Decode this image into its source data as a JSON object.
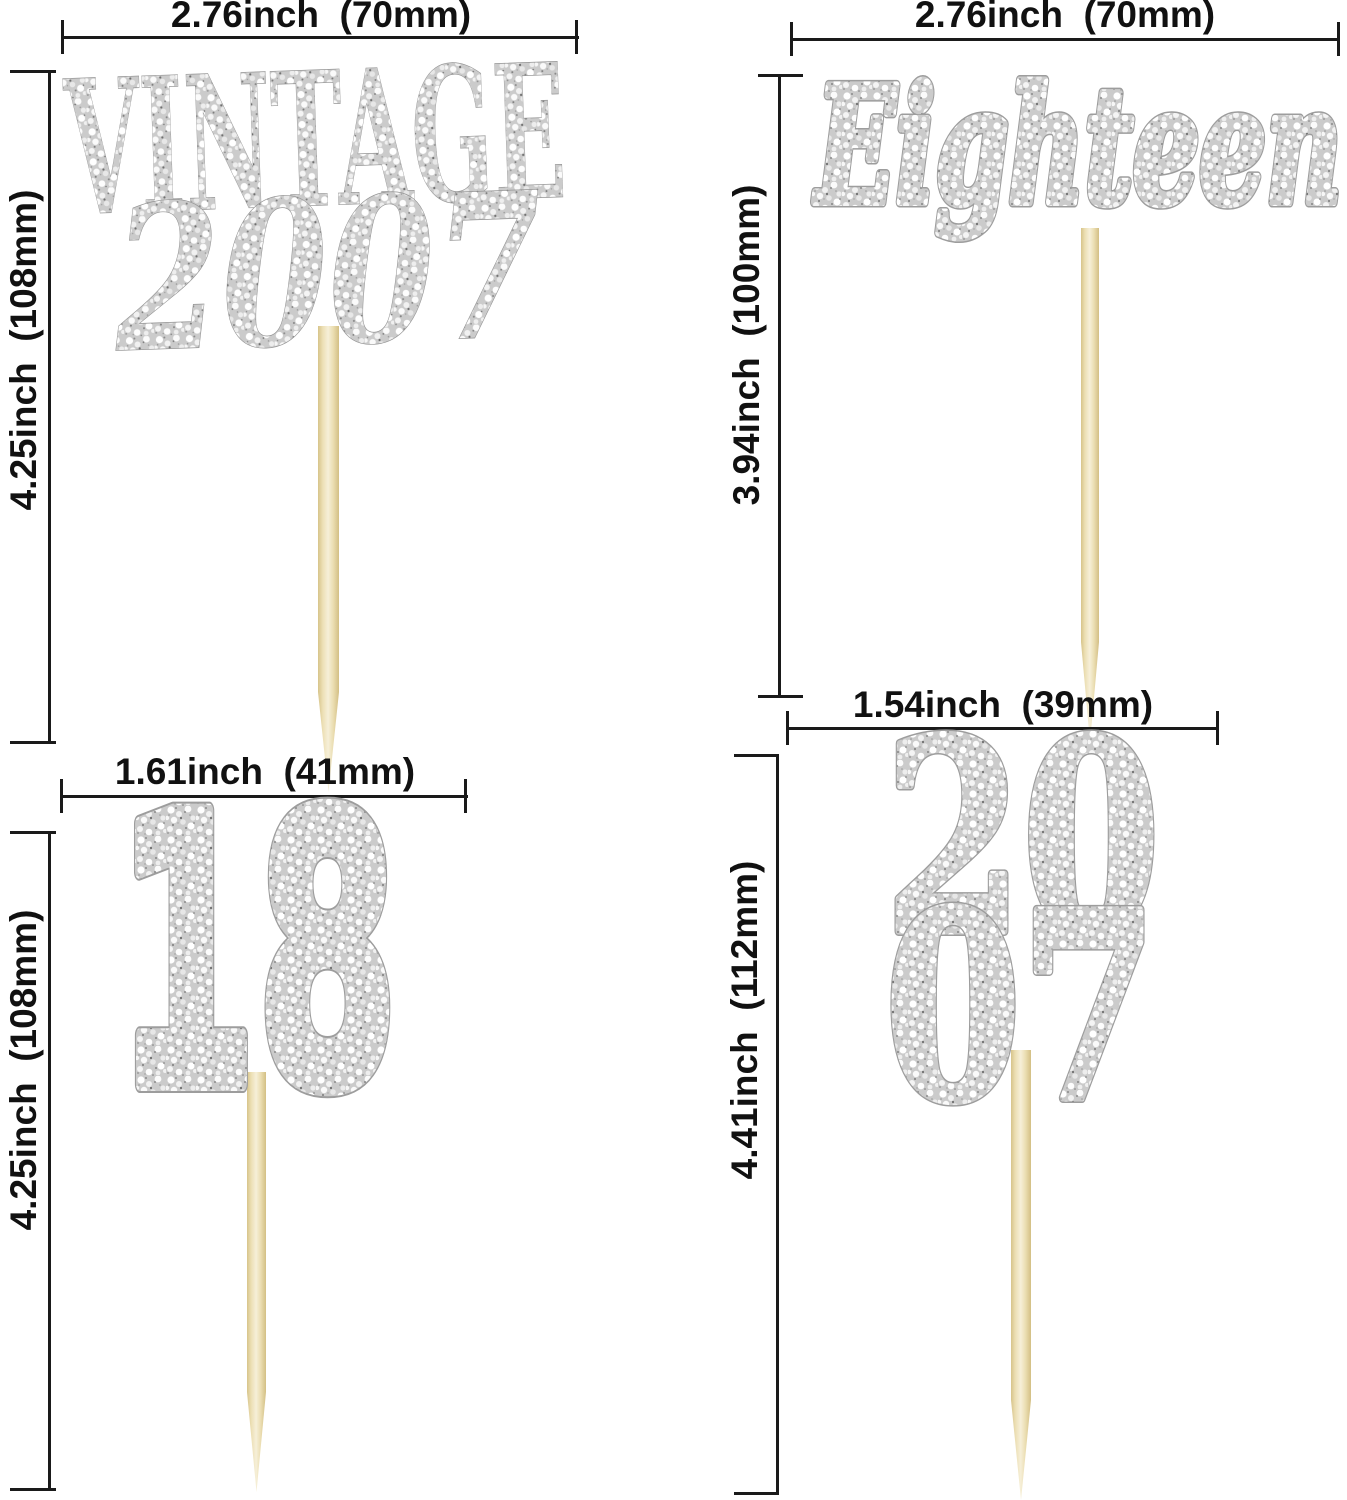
{
  "sheet": {
    "background": "#ffffff",
    "dimension_line_color": "#1a1a1a",
    "glitter_base_color": "#cbcbcb",
    "glitter_outline_color": "#9d9d9d",
    "pick_wood_color": "#ecdfb4"
  },
  "sections": {
    "vintage2007": {
      "line1": "VINTAGE",
      "line2": "2007",
      "width_label": "2.76inch  (70mm)",
      "height_label": "4.25inch  (108mm)"
    },
    "eighteenScript": {
      "text": "Eighteen",
      "width_label": "2.76inch  (70mm)",
      "height_label": "3.94inch  (100mm)"
    },
    "eighteenNumber": {
      "text": "18",
      "width_label": "1.61inch  (41mm)",
      "height_label": "4.25inch  (108mm)"
    },
    "year2007Stacked": {
      "line1": "20",
      "line2": "07",
      "width_label": "1.54inch  (39mm)",
      "height_label": "4.41inch  (112mm)"
    }
  }
}
